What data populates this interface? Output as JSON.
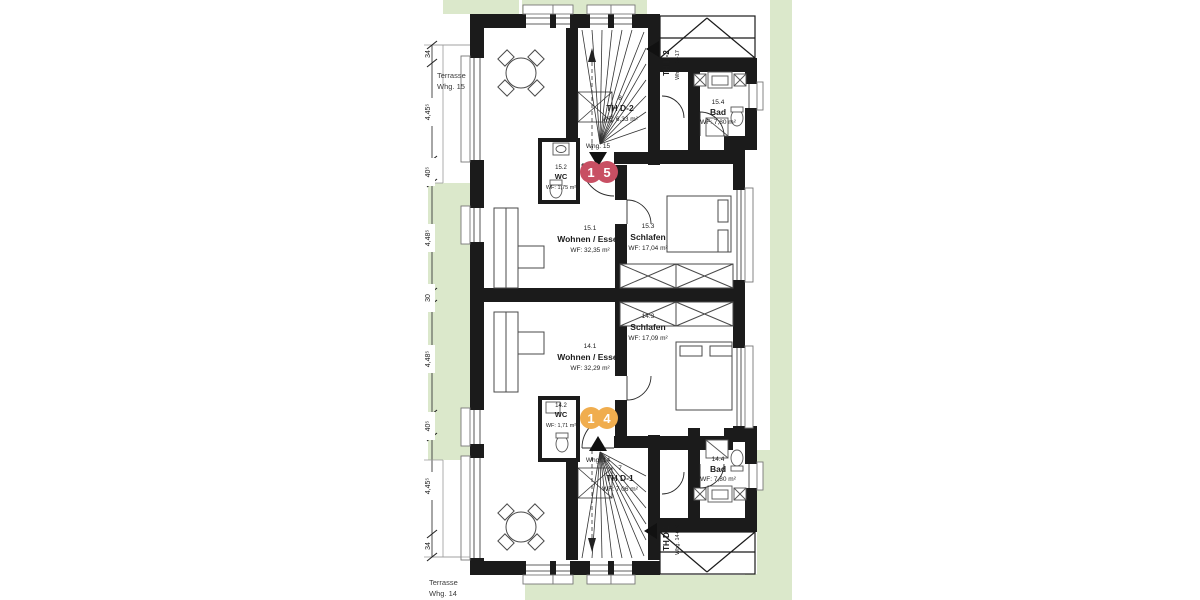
{
  "colors": {
    "lawn": "#dbe8cb",
    "wall": "#1b1b1b",
    "badge_whg15": "#c84f63",
    "badge_whg14": "#f0ad4e"
  },
  "plan": {
    "terraces": [
      {
        "line1": "Terrasse",
        "line2": "Whg. 15"
      },
      {
        "line1": "Terrasse",
        "line2": "Whg. 14"
      }
    ],
    "unit_markers": [
      {
        "digit1": "1",
        "digit2": "5",
        "label": "Whg. 15"
      },
      {
        "digit1": "1",
        "digit2": "4",
        "label": "Whg. 14"
      }
    ],
    "stair_tags": [
      {
        "name": "TH D-2",
        "sub": "Whg. 15+17"
      },
      {
        "name": "TH D-1",
        "sub": "Whg. 14+16"
      }
    ],
    "stairwells": [
      {
        "number": "8",
        "name": "TH D-2",
        "area": "WF: 6,33 m²"
      },
      {
        "number": "7",
        "name": "TH D-1",
        "area": "WF: 7,06 m²"
      }
    ],
    "rooms": [
      {
        "number": "15.1",
        "name": "Wohnen / Essen",
        "area": "WF: 32,35 m²"
      },
      {
        "number": "15.2",
        "name": "WC",
        "area": "WF: 1,75 m²"
      },
      {
        "number": "15.3",
        "name": "Schlafen",
        "area": "WF: 17,04 m²"
      },
      {
        "number": "15.4",
        "name": "Bad",
        "area": "WF: 7,80 m²"
      },
      {
        "number": "14.1",
        "name": "Wohnen / Essen",
        "area": "WF: 32,29 m²"
      },
      {
        "number": "14.2",
        "name": "WC",
        "area": "WF: 1,71 m²"
      },
      {
        "number": "14.3",
        "name": "Schlafen",
        "area": "WF: 17,09 m²"
      },
      {
        "number": "14.4",
        "name": "Bad",
        "area": "WF: 7,80 m²"
      }
    ],
    "dimensions_left": [
      "34",
      "4,45⁵",
      "40⁵",
      "4,48⁵",
      "30",
      "4,48⁵",
      "40⁵",
      "4,45⁵",
      "34"
    ]
  }
}
